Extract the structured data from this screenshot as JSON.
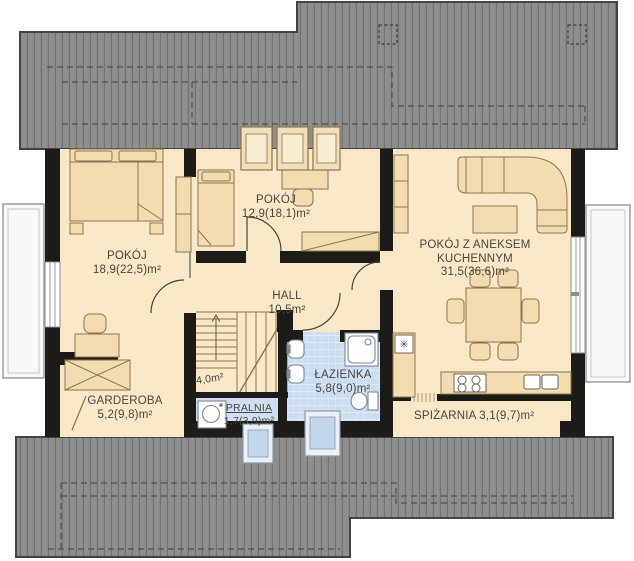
{
  "rooms": {
    "pokoj1": {
      "name": "POKÓJ",
      "area": "18,9(22,5)m²"
    },
    "pokoj2": {
      "name": "POKÓJ",
      "area": "12,9(18,1)m²"
    },
    "salon": {
      "name_line1": "POKÓJ Z ANEKSEM",
      "name_line2": "KUCHENNYM",
      "area": "31,5(36,6)m²"
    },
    "hall": {
      "name": "HALL",
      "area": "10,5m²"
    },
    "lazienka": {
      "name": "ŁAZIENKA",
      "area": "5,8(9,0)m²"
    },
    "garderoba": {
      "name": "GARDEROBA",
      "area": "5,2(9,8)m²"
    },
    "pralnia": {
      "name": "PRALNIA",
      "area": "1,7(3,9)m²"
    },
    "spizarnia": {
      "name": "SPIŻARNIA",
      "area": "3,1(9,7)m²"
    },
    "stairs": {
      "area": "4,0m²"
    }
  },
  "icons": {
    "fridge": "✳"
  },
  "colors": {
    "roof": "#8e8e8e",
    "roof_stripe": "#717171",
    "wall": "#1d1b17",
    "floor": "#f8e8c7",
    "furniture_fill": "#f3ddb0",
    "furniture_line": "#8b7551",
    "wet_room_floor": "#cadcef",
    "skylight": "#c3d7ec"
  }
}
